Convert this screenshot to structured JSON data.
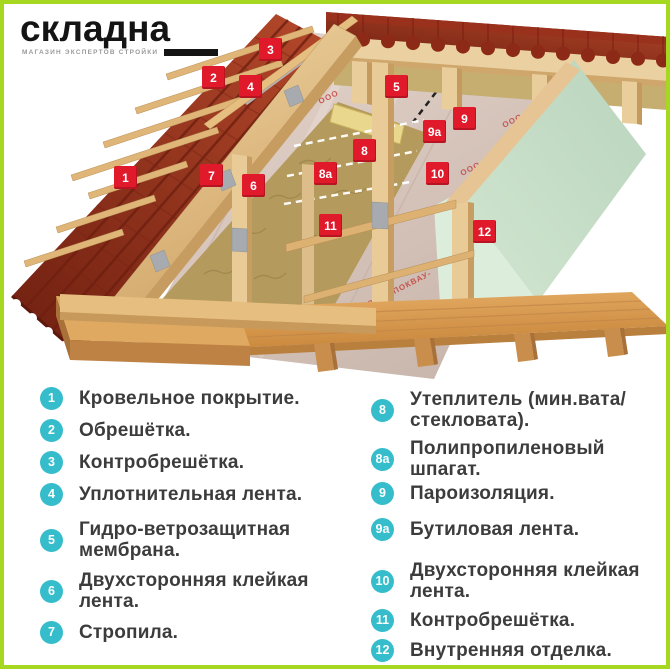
{
  "brand": {
    "name": "складна",
    "tagline": "МАГАЗИН ЭКСПЕРТОВ СТРОЙКИ"
  },
  "colors": {
    "accent_green": "#A6D821",
    "badge_teal": "#35BDCB",
    "marker_red": "#E0192B"
  },
  "illustration": {
    "membrane_watermark": "ООО -ПОКВАУ-",
    "markers": [
      {
        "label": "1"
      },
      {
        "label": "2"
      },
      {
        "label": "3"
      },
      {
        "label": "4"
      },
      {
        "label": "5"
      },
      {
        "label": "6"
      },
      {
        "label": "7"
      },
      {
        "label": "8"
      },
      {
        "label": "8а"
      },
      {
        "label": "9"
      },
      {
        "label": "9а"
      },
      {
        "label": "10"
      },
      {
        "label": "11"
      },
      {
        "label": "12"
      }
    ]
  },
  "legend": {
    "left": [
      {
        "num": "1",
        "text": "Кровельное покрытие."
      },
      {
        "num": "2",
        "text": "Обрешётка."
      },
      {
        "num": "3",
        "text": "Контробрешётка."
      },
      {
        "num": "4",
        "text": "Уплотнительная лента."
      },
      {
        "num": "5",
        "text": "Гидро-ветрозащитная мембрана."
      },
      {
        "num": "6",
        "text": "Двухсторонняя клейкая лента."
      },
      {
        "num": "7",
        "text": "Стропила."
      }
    ],
    "right": [
      {
        "num": "8",
        "text": "Утеплитель (мин.вата/​стекловата)."
      },
      {
        "num": "8а",
        "text": "Полипропиленовый шпагат."
      },
      {
        "num": "9",
        "text": "Пароизоляция."
      },
      {
        "num": "9а",
        "text": "Бутиловая лента."
      },
      {
        "num": "10",
        "text": "Двухсторонняя клейкая лента."
      },
      {
        "num": "11",
        "text": "Контробрешётка."
      },
      {
        "num": "12",
        "text": "Внутренняя отделка."
      }
    ]
  }
}
